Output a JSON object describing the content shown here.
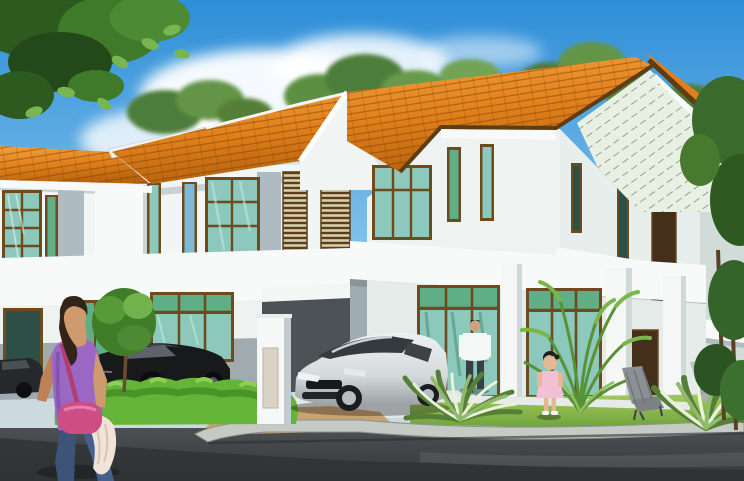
{
  "meta": {
    "title": "Artist impression of double-storey terrace houses",
    "width": 744,
    "height": 481
  },
  "palette": {
    "sky_top": "#2e8ed8",
    "sky_mid": "#7fc0ea",
    "sky_low": "#d8eef8",
    "cloud_white": "#ffffff",
    "foliage_dark": "#2c5a1f",
    "foliage_mid": "#4c8a33",
    "foliage_light": "#79b551",
    "roof_light": "#f2a23c",
    "roof_mid": "#e0801b",
    "roof_dark": "#b9650e",
    "fascia_white": "#f7faf9",
    "ridge_white": "#eef3f2",
    "trim_brown": "#5e3c14",
    "wall_white": "#f1f5f4",
    "wall_shade": "#d7e0e2",
    "pilaster_gray": "#aebbc1",
    "wall_gray_band": "#9fabaf",
    "carport_dark": "#4b5356",
    "gable_siding": "#e7f0e3",
    "gable_line": "#51614f",
    "frame_brown": "#6e4b1e",
    "glass_teal": "#8cc8bc",
    "glass_green": "#5fae86",
    "glass_blue": "#7fb9d6",
    "glass_dark": "#2e4f46",
    "panel_dark_brown": "#44301a",
    "hedge_green": "#63b437",
    "lawn_light": "#a3c95d",
    "lawn_dark": "#6fa33c",
    "walkway": "#ccdadf",
    "pad_tan": "#c7a372",
    "curb_gray": "#c6cac5",
    "road_mid": "#54585a",
    "road_dark": "#33373a",
    "car_black": "#17191b",
    "car_silver": "#d4d9da",
    "car_glass": "#343a3e",
    "skin": "#cf9a6e",
    "woman_top_purple": "#9a67c4",
    "jeans_blue": "#46608e",
    "bag_pink": "#cc4e85",
    "cloth_cream": "#f1e3d7",
    "hair_dark": "#33241a",
    "shirt_white": "#f5f7f6",
    "pants_dark": "#3a3f45",
    "dress_pink": "#f3bfd2",
    "chair_gray": "#8b9094",
    "chair_light": "#bcc2c1"
  },
  "objects": {
    "sky": {
      "label": "Blue sky with scattered white clouds"
    },
    "clouds": {
      "label": "White clouds"
    },
    "overhanging_tree": {
      "label": "Overhanging tree foliage at top left"
    },
    "background_trees": {
      "label": "Green trees behind the houses"
    },
    "right_trees": {
      "label": "Tall trees along the right edge"
    },
    "terrace_row": {
      "label": "Double-storey terrace house row with orange tiled roofs"
    },
    "corner_unit": {
      "label": "Corner unit with gable roof and siding"
    },
    "upper_windows": {
      "label": "Timber framed upper floor windows"
    },
    "louvers": {
      "label": "Timber louvre screens"
    },
    "porch": {
      "label": "Ground floor porch with white columns"
    },
    "glazing": {
      "label": "Full height timber framed glass doors"
    },
    "carport": {
      "label": "Shaded carport bay"
    },
    "pillar": {
      "label": "White gate pillar"
    },
    "black_car": {
      "label": "Black coupe parked behind the hedge"
    },
    "silver_car": {
      "label": "Silver coupe parked in the carport"
    },
    "edge_car": {
      "label": "Dark car at the left edge"
    },
    "woman": {
      "label": "Woman walking along the road with a pink handbag"
    },
    "man": {
      "label": "Man in white shirt standing at the porch"
    },
    "girl": {
      "label": "Girl in pink dress standing on the lawn"
    },
    "hedge": {
      "label": "Trimmed green hedge"
    },
    "sapling": {
      "label": "Small garden tree"
    },
    "palm": {
      "label": "Palm plant beside the porch"
    },
    "shrubs": {
      "label": "Variegated garden shrubs"
    },
    "chairs": {
      "label": "Outdoor lounge chairs on the lawn"
    },
    "lawn": {
      "label": "Front lawn"
    },
    "driveway": {
      "label": "Light concrete driveway"
    },
    "pad": {
      "label": "Tan paved apron at the gate"
    },
    "curb": {
      "label": "Concrete kerb"
    },
    "road": {
      "label": "Asphalt road"
    }
  }
}
